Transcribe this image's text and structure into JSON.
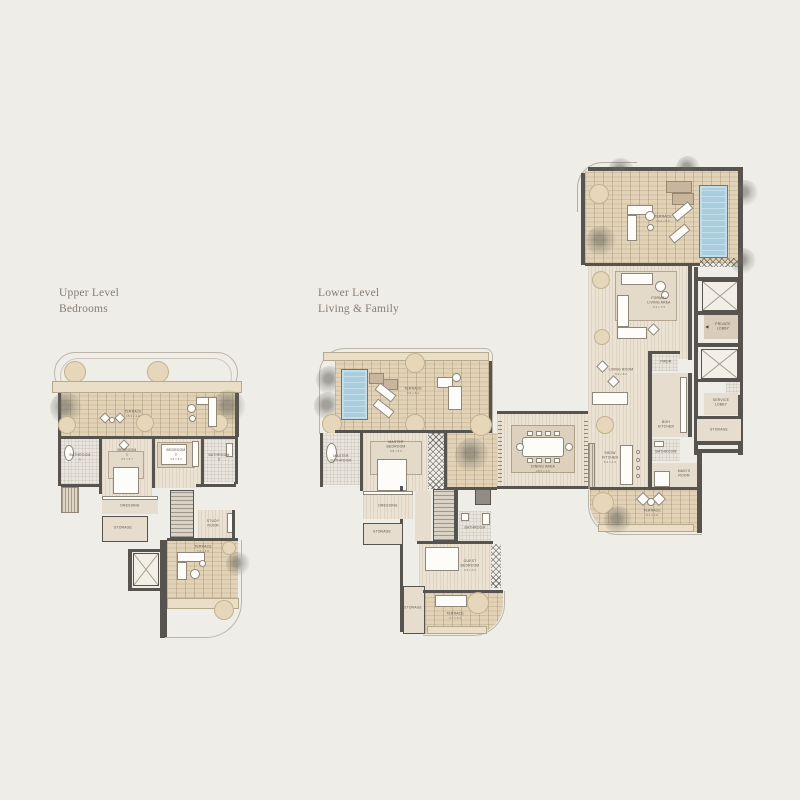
{
  "background": "#efede8",
  "titles": {
    "upper_line1": "Upper Level",
    "upper_line2": "Bedrooms",
    "lower_line1": "Lower Level",
    "lower_line2": "Living & Family"
  },
  "palette": {
    "wall": "#57534e",
    "brick": "#e2d3b8",
    "wood": "#ebe2d4",
    "parapet": "#eadfc6",
    "pool": "#a8cddd",
    "planter": "#e6d7bb",
    "label": "#5a5248"
  },
  "upper_plan": {
    "terrace": {
      "name": "TERRACE",
      "dims": "15.9 x 4.4"
    },
    "bathroom1": {
      "line1": "BATHROOM",
      "line2": "1"
    },
    "bedroom1": {
      "line1": "BEDROOM",
      "line2": "1",
      "dims": "4.5 x 5.7"
    },
    "bedroom2": {
      "line1": "BEDROOM",
      "line2": "2",
      "dims": "4.6 x 5.2"
    },
    "bathroom2": {
      "line1": "BATHROOM",
      "line2": "2"
    },
    "dressing": {
      "name": "DRESSING"
    },
    "storage": {
      "name": "STORAGE"
    },
    "study": {
      "line1": "STUDY",
      "line2": "ROOM"
    },
    "terrace2": {
      "name": "TERRACE",
      "dims": "7.0 x 4.6"
    }
  },
  "lower_plan": {
    "terrace_master": {
      "name": "TERRACE",
      "dims": "9.5 x 6.1"
    },
    "master_bathroom": {
      "line1": "MASTER",
      "line2": "BATHROOM"
    },
    "master_bedroom": {
      "line1": "MASTER",
      "line2": "BEDROOM",
      "dims": "5.8 x 5.0"
    },
    "dressing": {
      "name": "DRESSING"
    },
    "storage1": {
      "name": "STORAGE"
    },
    "bathroom": {
      "name": "BATHROOM"
    },
    "guest_bedroom": {
      "line1": "GUEST",
      "line2": "BEDROOM",
      "dims": "3.6 x 4.6"
    },
    "storage2": {
      "name": "STORAGE"
    },
    "terrace_guest": {
      "name": "TERRACE",
      "dims": "4.7 x 3.4"
    },
    "dining": {
      "name": "DINING AREA",
      "dims": "10.5 x 4.5"
    },
    "terrace_main": {
      "name": "TERRACE",
      "dims": "13.4 x 8.6"
    },
    "formal_living": {
      "line1": "FORMAL",
      "line2": "LIVING AREA",
      "dims": "6.1 x 7.3"
    },
    "living_room": {
      "name": "LIVING ROOM",
      "dims": "5.9 x 8.2"
    },
    "show_kitchen": {
      "line1": "SHOW",
      "line2": "KITCHEN",
      "dims": "5.4 x 4.3"
    },
    "boh_kitchen": {
      "line1": "BOH",
      "line2": "KITCHEN"
    },
    "pwdr": {
      "name": "PWDR"
    },
    "maid_bathroom": {
      "name": "BATHROOM"
    },
    "maids_room": {
      "line1": "MAID'S",
      "line2": "ROOM"
    },
    "private_lobby": {
      "line1": "PRIVATE",
      "line2": "LOBBY"
    },
    "service_lobby": {
      "line1": "SERVICE",
      "line2": "LOBBY"
    },
    "storage_lobby": {
      "name": "STORAGE"
    },
    "terrace_lower": {
      "name": "TERRACE",
      "dims": "9.1 x 2.8"
    },
    "entry_arrow": "◀"
  }
}
